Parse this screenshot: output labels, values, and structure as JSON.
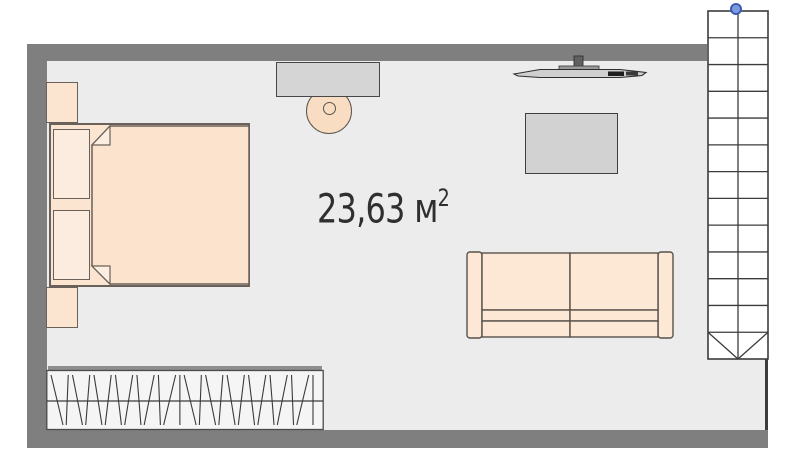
{
  "room": {
    "area_label": {
      "value": "23,63",
      "unit": "м",
      "superscript": "2"
    }
  },
  "furniture": {
    "items": [
      "bed",
      "pillow-left",
      "pillow-right",
      "nightstand-top",
      "nightstand-bottom",
      "wardrobe-with-hangers",
      "desk",
      "chair",
      "wall-tv",
      "tv-stand-table",
      "two-seat-sofa",
      "staircase"
    ]
  },
  "stairs": {
    "step_count": 13,
    "arrow": "v-down",
    "selected": true
  },
  "wardrobe": {
    "hanger_line_count": 26
  },
  "colors": {
    "background": "#ffffff",
    "wall": "#7f7f7f",
    "floor": "#ececec",
    "furniture_fill": "#fbe5d1",
    "furniture_outline": "#6a625a",
    "desk_fill": "#d5d5d5",
    "coffee_table_fill": "#d2d2d2",
    "stairs_outline": "#3c3c3c",
    "selection_handle": "#7d9ce0",
    "text": "#2f2f2f"
  }
}
